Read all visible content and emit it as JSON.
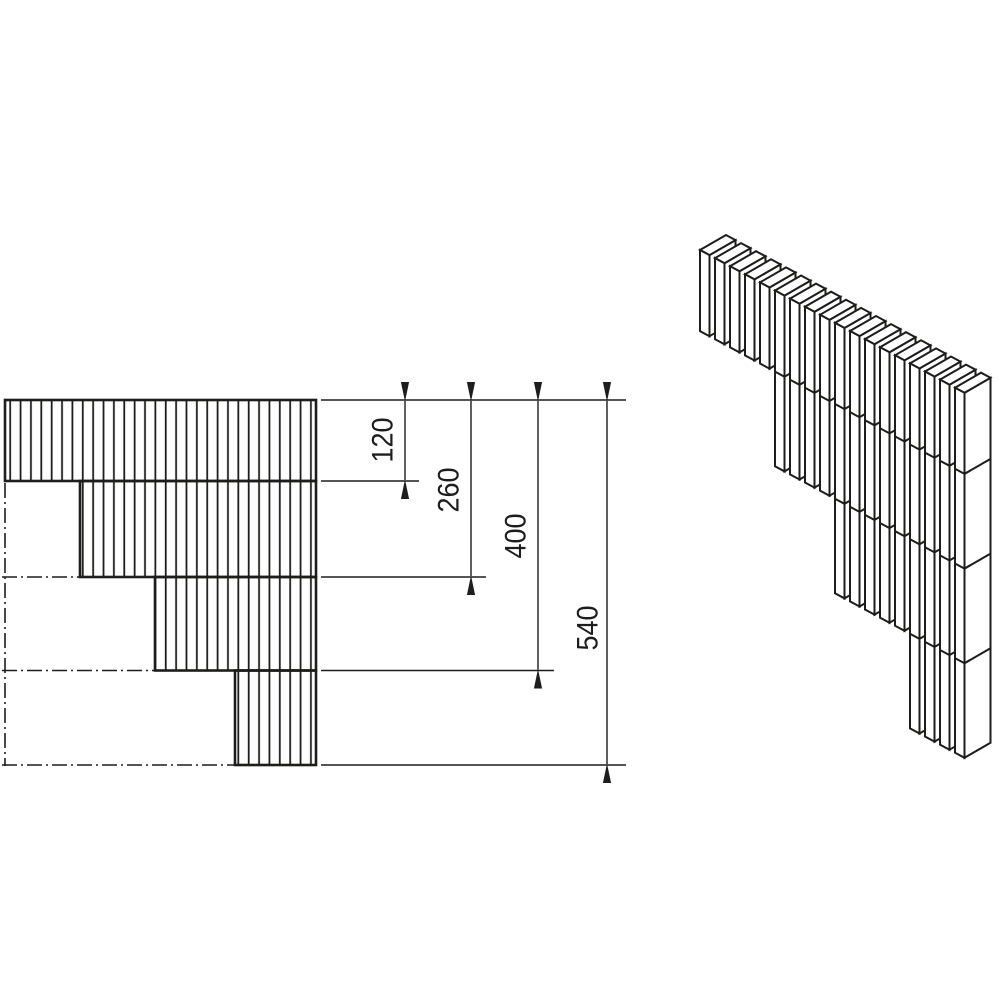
{
  "document": {
    "type": "technical-drawing",
    "description": "Stepped lamella wall corner: hatched elevation with dimension chain and isometric view of slat courses"
  },
  "colors": {
    "background": "#ffffff",
    "line": "#1d1d1b"
  },
  "dims": [
    {
      "label": "120",
      "value_units": 120
    },
    {
      "label": "260",
      "value_units": 260
    },
    {
      "label": "400",
      "value_units": 400
    },
    {
      "label": "540",
      "value_units": 540
    }
  ],
  "plan_view": {
    "rows": [
      {
        "height_units": 120,
        "inset_units": 0
      },
      {
        "height_units": 140,
        "inset_units": 111
      },
      {
        "height_units": 140,
        "inset_units": 222
      },
      {
        "height_units": 140,
        "inset_units": 340
      }
    ],
    "hatch_pitch_px": 10.37
  },
  "iso_view": {
    "origin": [
      700,
      250
    ],
    "column_step": [
      15,
      8.1
    ],
    "front_edge": [
      9.5,
      5.1
    ],
    "gap_edge": [
      5.5,
      -3.2
    ],
    "depth_edge": [
      26,
      -15
    ],
    "px_per_unit": 0.676,
    "groups": [
      {
        "columns": 5,
        "depth_units": 120
      },
      {
        "columns": 4,
        "depth_units": 260
      },
      {
        "columns": 5,
        "depth_units": 400
      },
      {
        "columns": 4,
        "depth_units": 540
      }
    ],
    "course_joints_units": [
      120,
      260,
      400
    ],
    "stroke_width": 2
  }
}
